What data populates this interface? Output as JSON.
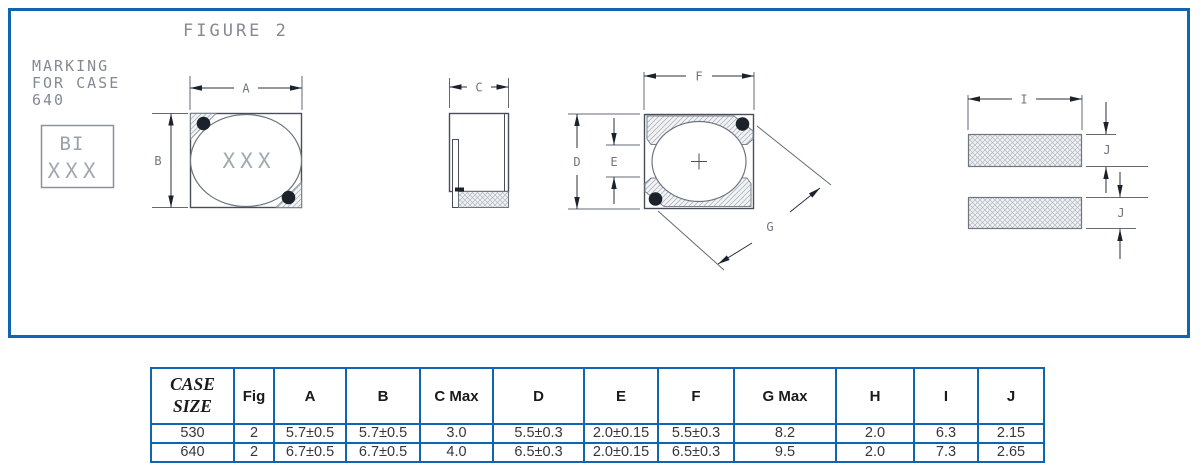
{
  "figure": {
    "title": "FIGURE 2",
    "marking_note": {
      "line1": "MARKING",
      "line2": "FOR CASE",
      "line3": "640"
    },
    "marking_box": {
      "line1": "BI",
      "line2": "XXX"
    },
    "top_view": {
      "body_marking": "XXX",
      "dim_a": "A",
      "dim_b": "B"
    },
    "side_view": {
      "dim_c": "C"
    },
    "bottom_view": {
      "dim_d": "D",
      "dim_e": "E",
      "dim_f": "F",
      "dim_g": "G"
    },
    "land_pattern": {
      "dim_i": "I",
      "dim_j_top": "J",
      "dim_j_bottom": "J"
    }
  },
  "table": {
    "headers": [
      "CASE SIZE",
      "Fig",
      "A",
      "B",
      "C Max",
      "D",
      "E",
      "F",
      "G Max",
      "H",
      "I",
      "J"
    ],
    "rows": [
      [
        "530",
        "2",
        "5.7±0.5",
        "5.7±0.5",
        "3.0",
        "5.5±0.3",
        "2.0±0.15",
        "5.5±0.3",
        "8.2",
        "2.0",
        "6.3",
        "2.15"
      ],
      [
        "640",
        "2",
        "6.7±0.5",
        "6.7±0.5",
        "4.0",
        "6.5±0.3",
        "2.0±0.15",
        "6.5±0.3",
        "9.5",
        "2.0",
        "7.3",
        "2.65"
      ]
    ]
  },
  "colors": {
    "frame_blue": "#1065b3",
    "table_border_blue": "#1065b3",
    "drawing_line": "#474e59",
    "dim_label_gray": "#6f7680",
    "cad_text_gray": "#848a94"
  }
}
